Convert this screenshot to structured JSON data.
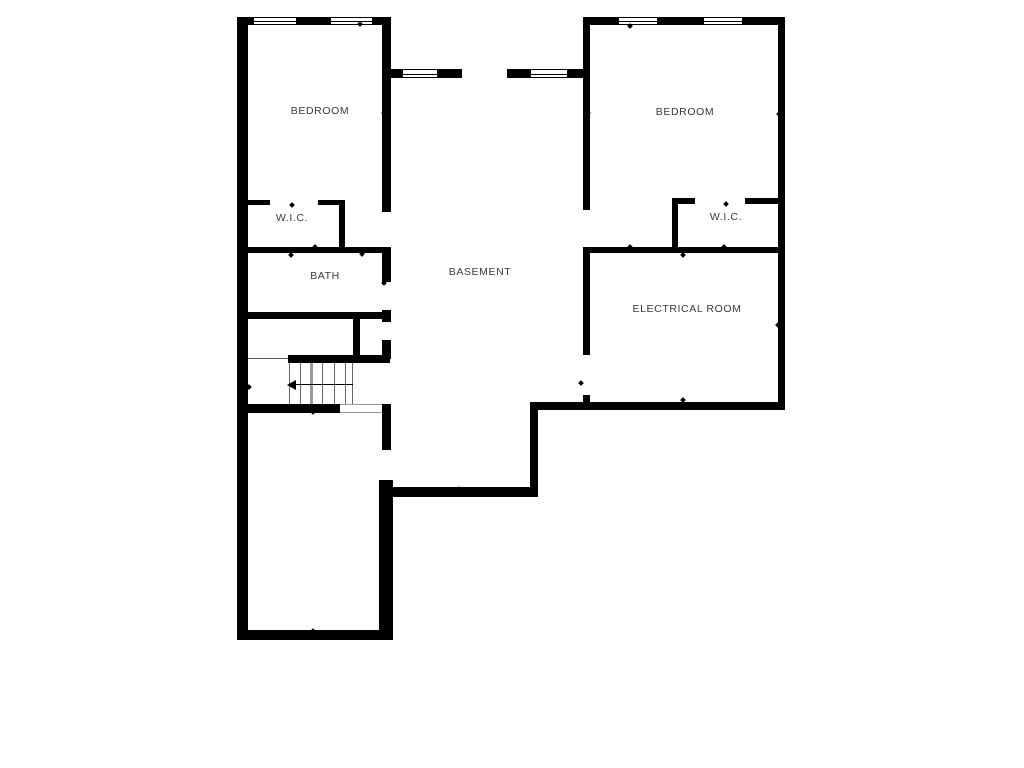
{
  "rooms": {
    "bedroom_left": {
      "label": "BEDROOM"
    },
    "bedroom_right": {
      "label": "BEDROOM"
    },
    "wic_left": {
      "label": "W.I.C."
    },
    "wic_right": {
      "label": "W.I.C."
    },
    "bath": {
      "label": "BATH"
    },
    "basement": {
      "label": "BASEMENT"
    },
    "electrical_room": {
      "label": "ELECTRICAL ROOM"
    }
  },
  "stairs": {
    "direction_arrow": "left"
  },
  "colors": {
    "wall": "#000000",
    "background": "#ffffff",
    "label_text": "#3a3a3a",
    "stair_lines": "#666666"
  }
}
